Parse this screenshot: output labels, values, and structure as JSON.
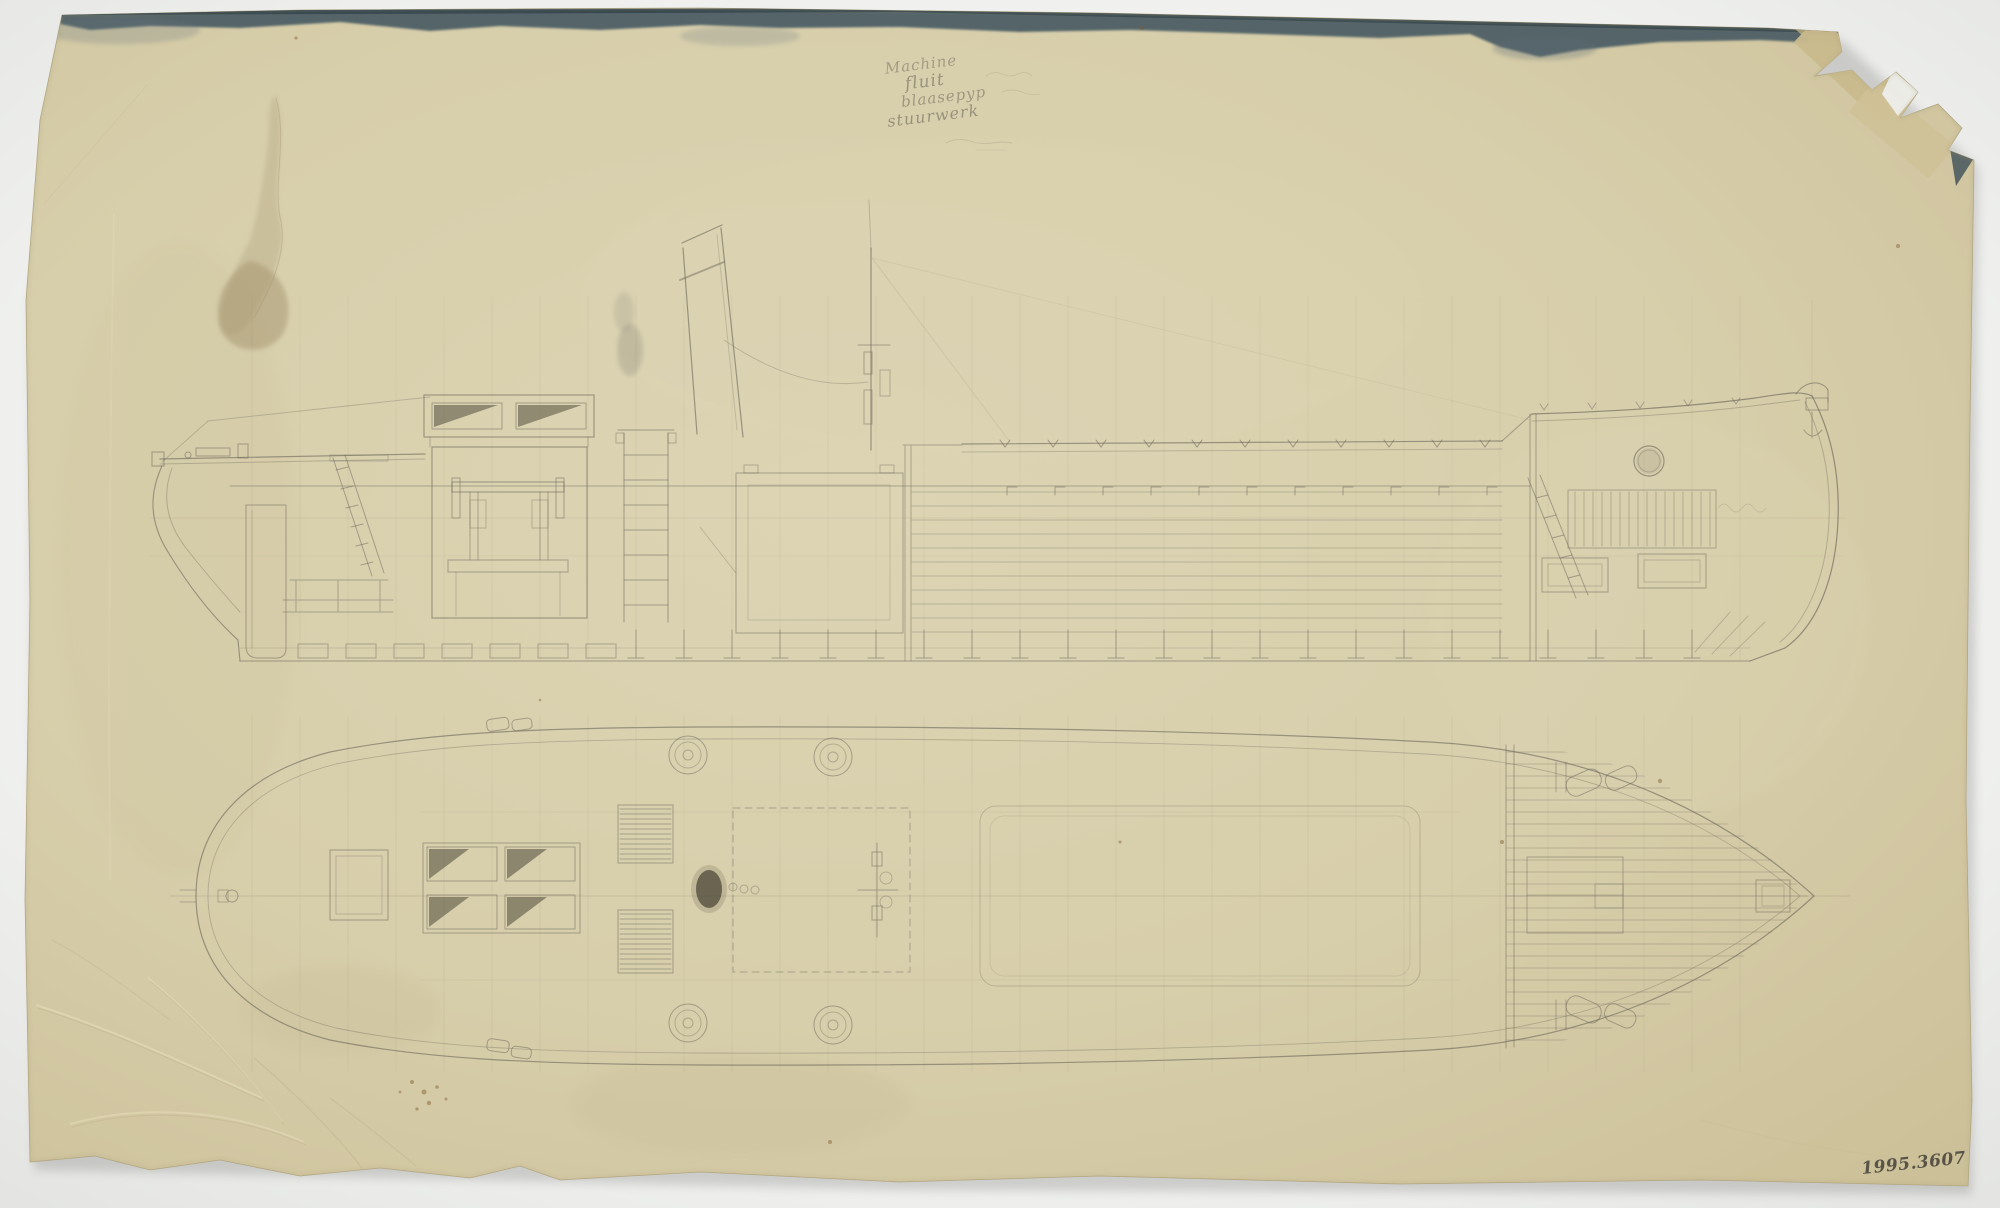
{
  "inscription": {
    "line1": "Machine",
    "line2": "fluit",
    "line3": "blaasepyp",
    "line4": "stuurwerk"
  },
  "catalog_number": "1995.3607",
  "colors": {
    "backdrop": "#f0f1ee",
    "paper": "#d8cfae",
    "pencil": "#6b665a",
    "top_edge_band": "#4a5b64",
    "tape": "#c8ba8d",
    "stain": "#b1a17c"
  }
}
